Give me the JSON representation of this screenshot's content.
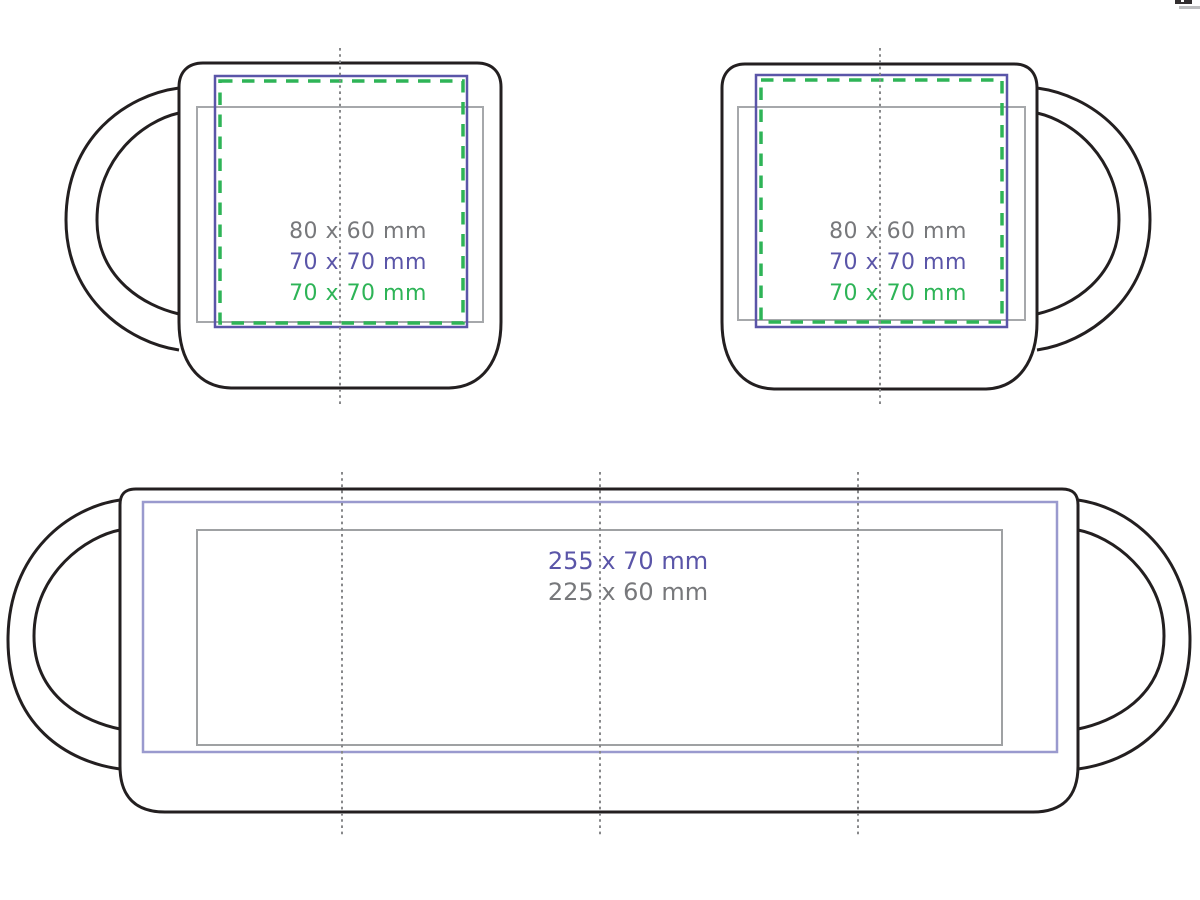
{
  "diagram": {
    "background": "#ffffff",
    "outline_color": "#231f20",
    "centerline_color": "#87888a",
    "views": {
      "front_left": {
        "description": "mug front view, handle on left",
        "labels": [
          {
            "text": "80 x 60 mm",
            "color": "#77787b",
            "area": "gray-frame"
          },
          {
            "text": "70 x 70 mm",
            "color": "#5a55a8",
            "area": "blue-frame"
          },
          {
            "text": "70 x 70 mm",
            "color": "#2eb457",
            "area": "green-dashed-frame"
          }
        ]
      },
      "front_right": {
        "description": "mug front view, handle on right",
        "labels": [
          {
            "text": "80 x 60 mm",
            "color": "#77787b",
            "area": "gray-frame"
          },
          {
            "text": "70 x 70 mm",
            "color": "#5a55a8",
            "area": "blue-frame"
          },
          {
            "text": "70 x 70 mm",
            "color": "#2eb457",
            "area": "green-dashed-frame"
          }
        ]
      },
      "wrap": {
        "description": "unwrapped full-wrap print view with both handle silhouettes",
        "labels": [
          {
            "text": "255 x 70 mm",
            "color": "#5a55a8",
            "area": "light-blue-frame"
          },
          {
            "text": "225 x 60 mm",
            "color": "#77787b",
            "area": "gray-frame"
          }
        ]
      }
    },
    "frame_colors": {
      "gray_frame": "#a6a8ab",
      "blue_frame": "#5a55a8",
      "green_dashed_frame": "#2eb457",
      "light_blue_frame": "#9a9ace",
      "wrap_gray_frame": "#9fa1a3"
    }
  }
}
